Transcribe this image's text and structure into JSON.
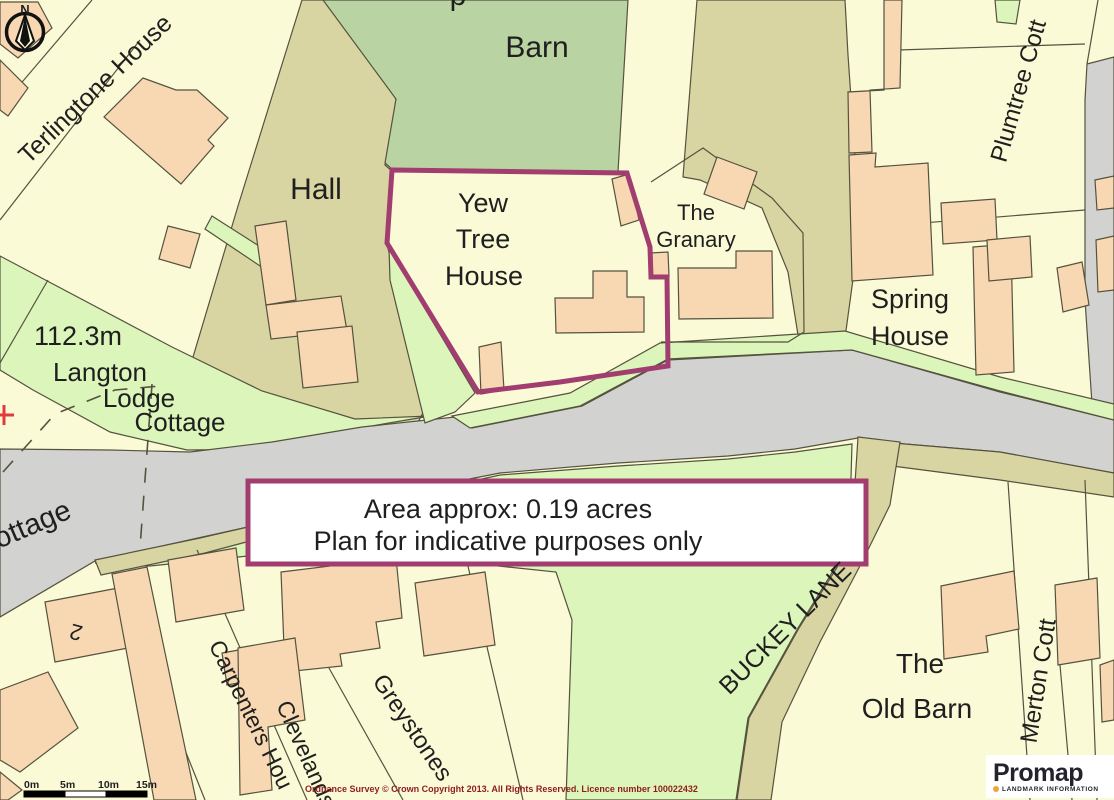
{
  "app": {
    "kind": "Promap exported site plan"
  },
  "colors": {
    "cream": "#FAFAD7",
    "peach": "#F8D8B2",
    "sage": "#BAD3A2",
    "khaki": "#D9D5A3",
    "lgreen": "#DCF5BB",
    "road": "#D2D2D0",
    "line": "#55523E",
    "accent": "#A13D6F",
    "text": "#1F1F1F",
    "red": "#E23B3B",
    "copyright_red": "#8F1D1D",
    "navy": "#23232F",
    "orange": "#F2A33C"
  },
  "map": {
    "annotation_box": {
      "line1": "Area approx: 0.19 acres",
      "line2": "Plan for indicative purposes only"
    },
    "copyright": "Ordnance Survey © Crown Copyright 2013. All Rights Reserved. Licence number 100022432",
    "scale_bar": {
      "ticks": [
        "0m",
        "5m",
        "10m",
        "15m"
      ]
    },
    "north_indicator": "N",
    "logo": {
      "brand": "Promap",
      "tagline": "LANDMARK INFORMATION"
    },
    "labels": [
      {
        "id": "terlingtone-house",
        "text": "Terlingtone House",
        "x": 101,
        "y": 95,
        "size": 25,
        "rotate": -44
      },
      {
        "id": "cut-top-fragment",
        "text": "p",
        "x": 458,
        "y": 5,
        "size": 30,
        "rotate": 0
      },
      {
        "id": "barn",
        "text": "Barn",
        "x": 537,
        "y": 57,
        "size": 30,
        "rotate": 0
      },
      {
        "id": "hall",
        "text": "Hall",
        "x": 316,
        "y": 199,
        "size": 30,
        "rotate": 0
      },
      {
        "id": "yew-line-1",
        "text": "Yew",
        "x": 483,
        "y": 212,
        "size": 27,
        "rotate": 0
      },
      {
        "id": "yew-line-2",
        "text": "Tree",
        "x": 483,
        "y": 248,
        "size": 27,
        "rotate": 0
      },
      {
        "id": "yew-line-3",
        "text": "House",
        "x": 484,
        "y": 285,
        "size": 27,
        "rotate": 0
      },
      {
        "id": "granary-line-1",
        "text": "The",
        "x": 696,
        "y": 220,
        "size": 22,
        "rotate": 0
      },
      {
        "id": "granary-line-2",
        "text": "Granary",
        "x": 696,
        "y": 247,
        "size": 22,
        "rotate": 0
      },
      {
        "id": "plumtree-cott",
        "text": "Plumtree Cott",
        "x": 1026,
        "y": 93,
        "size": 24,
        "rotate": -74
      },
      {
        "id": "spot-height",
        "text": "112.3m",
        "x": 78,
        "y": 345,
        "size": 27,
        "rotate": 0
      },
      {
        "id": "langton-line-1",
        "text": "Langton",
        "x": 100,
        "y": 381,
        "size": 26,
        "rotate": 0
      },
      {
        "id": "langton-line-2",
        "text": "Lodge",
        "x": 139,
        "y": 407,
        "size": 26,
        "rotate": 0
      },
      {
        "id": "langton-line-3",
        "text": "Cottage",
        "x": 180,
        "y": 431,
        "size": 26,
        "rotate": 0
      },
      {
        "id": "cottage-partial",
        "text": "ottage",
        "x": 36,
        "y": 533,
        "size": 29,
        "rotate": -23
      },
      {
        "id": "house-number-2",
        "text": "2",
        "x": 78,
        "y": 625,
        "size": 22,
        "rotate": 195
      },
      {
        "id": "carpenters-house",
        "text": "Carpenters Hou",
        "x": 244,
        "y": 718,
        "size": 23,
        "rotate": 64
      },
      {
        "id": "clevelands",
        "text": "Clevelands",
        "x": 299,
        "y": 757,
        "size": 23,
        "rotate": 66
      },
      {
        "id": "greystones",
        "text": "Greystones",
        "x": 406,
        "y": 732,
        "size": 24,
        "rotate": 56
      },
      {
        "id": "buckey-lane",
        "text": "BUCKEY LANE",
        "x": 791,
        "y": 634,
        "size": 25,
        "rotate": -45
      },
      {
        "id": "old-barn-line-1",
        "text": "The",
        "x": 920,
        "y": 673,
        "size": 28,
        "rotate": 0
      },
      {
        "id": "old-barn-line-2",
        "text": "Old Barn",
        "x": 917,
        "y": 718,
        "size": 28,
        "rotate": 0
      },
      {
        "id": "merton-cott",
        "text": "Merton Cott",
        "x": 1046,
        "y": 682,
        "size": 24,
        "rotate": -81
      },
      {
        "id": "spring-line-1",
        "text": "Spring",
        "x": 910,
        "y": 308,
        "size": 27,
        "rotate": 0
      },
      {
        "id": "spring-line-2",
        "text": "House",
        "x": 910,
        "y": 345,
        "size": 27,
        "rotate": 0
      },
      {
        "id": "area-line-1",
        "text": "Area approx: 0.19 acres",
        "x": 508,
        "y": 518,
        "size": 27,
        "rotate": 0
      },
      {
        "id": "area-line-2",
        "text": "Plan for indicative purposes only",
        "x": 508,
        "y": 550,
        "size": 27,
        "rotate": 0
      },
      {
        "id": "copyright",
        "text": "Ordnance Survey © Crown Copyright 2013. All Rights Reserved. Licence number 100022432",
        "x": 305,
        "y": 792,
        "size": 9,
        "rotate": 0,
        "weight": 700,
        "color": "#8F1D1D",
        "anchor": "start"
      },
      {
        "id": "scale-tick-0m",
        "text": "0m",
        "x": 24,
        "y": 788,
        "size": 10.5,
        "rotate": 0,
        "weight": 700,
        "anchor": "start"
      },
      {
        "id": "scale-tick-5m",
        "text": "5m",
        "x": 60,
        "y": 788,
        "size": 10.5,
        "rotate": 0,
        "weight": 700,
        "anchor": "start"
      },
      {
        "id": "scale-tick-10m",
        "text": "10m",
        "x": 98,
        "y": 788,
        "size": 10.5,
        "rotate": 0,
        "weight": 700,
        "anchor": "start"
      },
      {
        "id": "scale-tick-15m",
        "text": "15m",
        "x": 136,
        "y": 788,
        "size": 10.5,
        "rotate": 0,
        "weight": 700,
        "anchor": "start"
      },
      {
        "id": "north-letter",
        "text": "N",
        "x": 25,
        "y": 14,
        "size": 13,
        "rotate": 0,
        "weight": 700
      }
    ]
  }
}
